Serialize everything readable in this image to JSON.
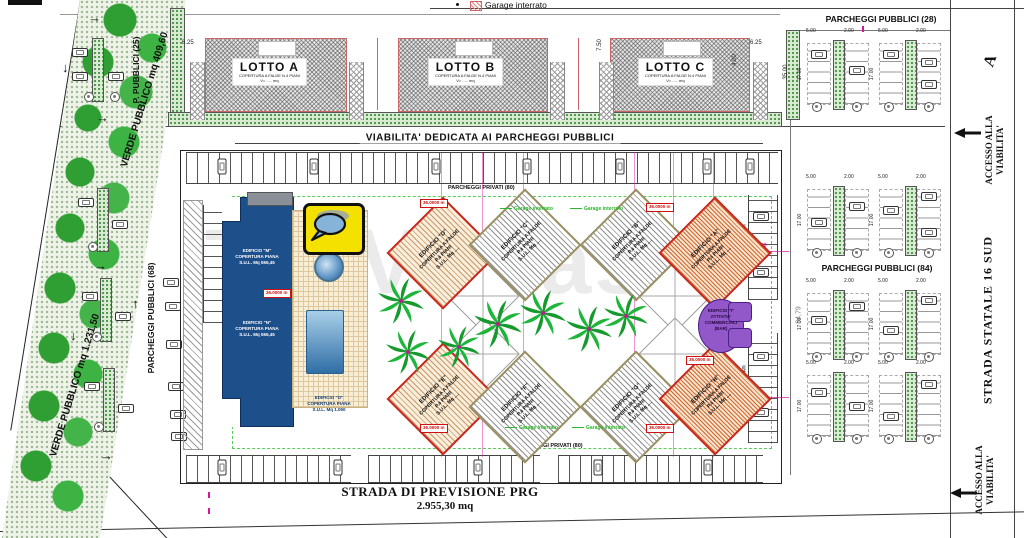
{
  "canvas": {
    "width": 1024,
    "height": 538
  },
  "icons": {
    "arrow_right": "→",
    "arrow_left": "←",
    "arrow_up": "↑",
    "arrow_down": "↓",
    "tree_icon": "palm-tree",
    "car_icon": "car",
    "speech_bubble": "speech-bubble"
  },
  "colors": {
    "magenta": "#d4179a",
    "red": "#cc2218",
    "blue_building": "#1d4f8a",
    "green": "#2db52d",
    "purple": "#9257c9",
    "yellow_logo": "#f5e100"
  },
  "watermark": "TroVaCasa",
  "legend": {
    "garage_interrato": "Garage interrato"
  },
  "left_area": {
    "verde_label": "VERDE PUBBLICO",
    "verde_top_mq": "mq 409,60",
    "verde_bottom_mq": "mq 1.231,50",
    "p_pubblici": "P. PUBBLICI (25)",
    "parcheggi_68": "PARCHEGGI PUBBLICI (68)"
  },
  "top_area": {
    "parcheggi_28": "PARCHEGGI PUBBLICI (28)",
    "lotti": [
      {
        "name": "LOTTO A",
        "sub1": "COPERTURA A FALDE  N.4 PIANI",
        "sub2": "V= ..... mq"
      },
      {
        "name": "LOTTO B",
        "sub1": "COPERTURA A FALDE  N.4 PIANI",
        "sub2": "V= ..... mq"
      },
      {
        "name": "LOTTO C",
        "sub1": "COPERTURA A FALDE  N.4 PIANI",
        "sub2": "V= ..... mq"
      }
    ]
  },
  "center": {
    "viabilita": "VIABILITA' DEDICATA AI PARCHEGGI PUBBLICI",
    "parcheggi_privati_top": "PARCHEGGI PRIVATI (80)",
    "parcheggi_privati_bottom": "PARCHEGGI PRIVATI (80)",
    "parcheggi_privati_right": "PARCHEGGI PRIVATI",
    "garage_interrato": "Garage interrato",
    "quota": "36.0000 m",
    "edifici_diamond": [
      {
        "name": "EDIFICIO \"D\"",
        "l1": "COPERTURA A FALDE",
        "l2": "P.4 PIANI",
        "l3": "S.U.L. Mq ...."
      },
      {
        "name": "EDIFICIO \"C\"",
        "l1": "COPERTURA A FALDE",
        "l2": "P.4 PIANI",
        "l3": "S.U.L. Mq ...."
      },
      {
        "name": "EDIFICIO \"B\"",
        "l1": "COPERTURA A FALDE",
        "l2": "P.4 PIANI",
        "l3": "S.U.L. Mq ...."
      },
      {
        "name": "EDIFICIO \"A\"",
        "l1": "COPERTURA A FALDE",
        "l2": "P.4 PIANI",
        "l3": "S.U.L. Mq ...."
      },
      {
        "name": "EDIFICIO \"E\"",
        "l1": "COPERTURA A FALDE",
        "l2": "P.4 PIANI",
        "l3": "S.U.L. Mq ...."
      },
      {
        "name": "EDIFICIO \"F\"",
        "l1": "COPERTURA A FALDE",
        "l2": "P.4 PIANI",
        "l3": "S.U.L. Mq ...."
      },
      {
        "name": "EDIFICIO \"G\"",
        "l1": "COPERTURA A FALDE",
        "l2": "P.4 PIANI",
        "l3": "S.U.L. Mq ...."
      },
      {
        "name": "EDIFICIO \"H\"",
        "l1": "COPERTURA A FALDE",
        "l2": "P.4 PIANI",
        "l3": "S.U.L. Mq ...."
      }
    ],
    "edifici_blue": [
      {
        "name": "EDIFICIO \"M\"",
        "l1": "COPERTURA PIANA",
        "l2": "S.U.L. Mq 555,45"
      },
      {
        "name": "EDIFICIO \"N\"",
        "l1": "COPERTURA PIANA",
        "l2": "S.U.L. Mq 555,45"
      },
      {
        "name": "EDIFICIO \"O\"",
        "l1": "COPERTURA PIANA",
        "l2": "S.U.L. Mq 1.050"
      }
    ],
    "edificio_i": {
      "name": "EDIFICIO \"I\"",
      "l1": "ATTIVITA'",
      "l2": "COMMERCIALI",
      "l3": "(BAR)"
    }
  },
  "right_area": {
    "parcheggi_84": "PARCHEGGI PUBBLICI (84)",
    "strada_statale": "STRADA STATALE 16 SUD",
    "accesso_top": "ACCESSO ALLA VIABILITA'",
    "accesso_bottom": "ACCESSO ALLA VIABILITA'",
    "marker_a": "A"
  },
  "bottom_area": {
    "strada_prev": "STRADA DI PREVISIONE PRG",
    "strada_prev_mq": "2.955,30 mq"
  },
  "dims": {
    "d625": "6.25",
    "d750": "7.50",
    "d400": "4.00",
    "d3500": "35.00",
    "d500": "5.00",
    "d200": "2.00",
    "d1700": "17.00",
    "d8479": "84,79",
    "d1510": "15.10",
    "d1000": "10.00"
  }
}
